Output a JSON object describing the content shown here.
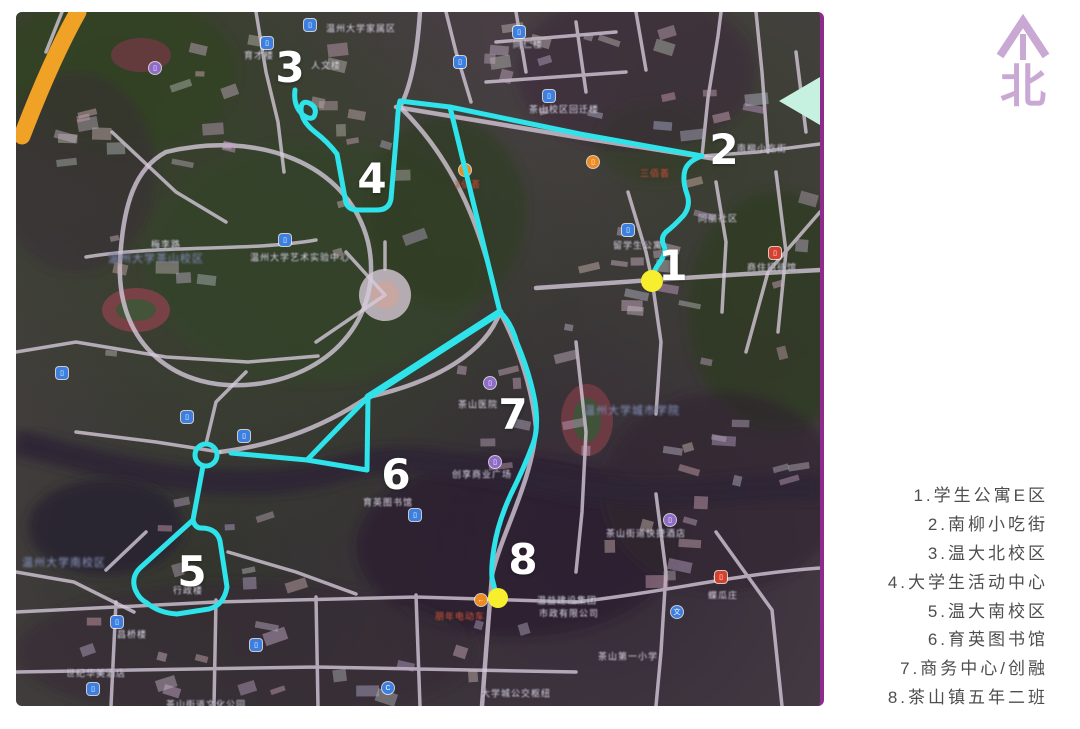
{
  "compass": {
    "north_label": "北",
    "color": "#c9a8d4"
  },
  "legend": {
    "text_color": "#4e4e4e",
    "items": [
      "1.学生公寓E区",
      "2.南柳小吃街",
      "3.温大北校区",
      "4.大学生活动中心",
      "5.温大南校区",
      "6.育英图书馆",
      "7.商务中心/创融",
      "8.茶山镇五年二班"
    ]
  },
  "map": {
    "edge_color": "#8e2b8c",
    "direction_arrow_color": "#c6f0e0",
    "route": {
      "color": "#2ee3ea",
      "stroke_width": 5,
      "paths": [
        "M 279,78 Q 277,94 287,103 Q 297,110 299,102 Q 301,95 293,91 Q 285,88 285,98 Q 286,110 299,120 Q 312,130 321,142 L 329,186 Q 330,198 342,198 L 361,198 Q 373,198 375,187 L 381,116 Q 382,95 384,89",
        "M 384,89 L 434,95 L 564,122 L 686,144",
        "M 686,144 Q 672,149 669,158 Q 666,168 671,182 Q 675,193 668,203 Q 658,214 650,220 Q 644,226 648,234 Q 651,240 644,250 Q 637,259 636,268",
        "M 434,95 L 481,288 L 484,300",
        "M 484,300 Q 495,310 501,331 Q 514,362 519,390 Q 523,416 517,432 Q 508,456 495,482 Q 482,510 478,536 Q 475,555 476,566 L 481,586",
        "M 484,300 L 352,385",
        "M 352,385 L 291,448 M 352,385 L 351,458",
        "M 351,458 L 291,448 L 215,441",
        "M 187,454 L 177,508",
        "M 177,508 L 124,556 Q 115,565 119,577 Q 123,587 131,591 Q 143,601 161,602 L 193,597 Q 208,593 211,575 L 204,529 Q 201,517 187,516 Q 179,517 177,508"
      ],
      "circles": [
        {
          "x": 190,
          "y": 443,
          "r": 11
        }
      ]
    },
    "stop_numbers": [
      {
        "label": "1",
        "x": 657,
        "y": 254
      },
      {
        "label": "2",
        "x": 708,
        "y": 138
      },
      {
        "label": "3",
        "x": 274,
        "y": 56
      },
      {
        "label": "4",
        "x": 356,
        "y": 167
      },
      {
        "label": "5",
        "x": 176,
        "y": 560
      },
      {
        "label": "6",
        "x": 380,
        "y": 463
      },
      {
        "label": "7",
        "x": 497,
        "y": 403
      },
      {
        "label": "8",
        "x": 507,
        "y": 548
      }
    ],
    "endpoint_dots": [
      {
        "x": 636,
        "y": 269,
        "r": 11
      },
      {
        "x": 482,
        "y": 586,
        "r": 10
      }
    ],
    "endpoint_dot_color": "#f7ef2d",
    "area_labels": [
      {
        "text": "温州大学家属区",
        "x": 345,
        "y": 16,
        "c": "w"
      },
      {
        "text": "人文楼",
        "x": 310,
        "y": 53,
        "c": "w"
      },
      {
        "text": "育才楼",
        "x": 243,
        "y": 43,
        "c": "w"
      },
      {
        "text": "同仁楼",
        "x": 512,
        "y": 32,
        "c": "w"
      },
      {
        "text": "茶山校区回迁楼",
        "x": 548,
        "y": 97,
        "c": "w"
      },
      {
        "text": "温州大学茶山校区",
        "x": 140,
        "y": 246,
        "c": "b"
      },
      {
        "text": "温州大学艺术实验中心",
        "x": 284,
        "y": 245,
        "c": "w"
      },
      {
        "text": "三佰荟",
        "x": 639,
        "y": 161,
        "c": "r"
      },
      {
        "text": "2佰荟",
        "x": 452,
        "y": 172,
        "c": "r"
      },
      {
        "text": "留学生公寓",
        "x": 622,
        "y": 233,
        "c": "w"
      },
      {
        "text": "南柳小吃街",
        "x": 746,
        "y": 136,
        "c": "w"
      },
      {
        "text": "同丽社区",
        "x": 702,
        "y": 206,
        "c": "w"
      },
      {
        "text": "商住招待馆",
        "x": 756,
        "y": 255,
        "c": "w"
      },
      {
        "text": "梅李路",
        "x": 150,
        "y": 232,
        "c": "w"
      },
      {
        "text": "育英图书馆",
        "x": 372,
        "y": 490,
        "c": "w"
      },
      {
        "text": "温州大学南校区",
        "x": 48,
        "y": 550,
        "c": "b"
      },
      {
        "text": "行政楼",
        "x": 172,
        "y": 578,
        "c": "w"
      },
      {
        "text": "茶山医院",
        "x": 462,
        "y": 392,
        "c": "w"
      },
      {
        "text": "创享商业广场",
        "x": 466,
        "y": 462,
        "c": "w"
      },
      {
        "text": "温州大学城市学院",
        "x": 616,
        "y": 398,
        "c": "b"
      },
      {
        "text": "茶山街道快捷酒店",
        "x": 630,
        "y": 521,
        "c": "w"
      },
      {
        "text": "蝶瓜庄",
        "x": 707,
        "y": 583,
        "c": "w"
      },
      {
        "text": "茶山第一小学",
        "x": 612,
        "y": 644,
        "c": "w"
      },
      {
        "text": "世纪华美酒店",
        "x": 80,
        "y": 661,
        "c": "w"
      },
      {
        "text": "昌桥楼",
        "x": 116,
        "y": 622,
        "c": "w"
      },
      {
        "text": "茶山街道文化公园",
        "x": 190,
        "y": 692,
        "c": "w"
      },
      {
        "text": "大学城公交枢纽",
        "x": 500,
        "y": 681,
        "c": "w"
      },
      {
        "text": "朋年电动车",
        "x": 444,
        "y": 604,
        "c": "r"
      },
      {
        "text": "温益建设集团",
        "x": 551,
        "y": 588,
        "c": "w"
      },
      {
        "text": "市政有限公司",
        "x": 553,
        "y": 601,
        "c": "w"
      }
    ],
    "poi_icons": [
      {
        "x": 294,
        "y": 13,
        "kind": "blue"
      },
      {
        "x": 503,
        "y": 20,
        "kind": "blue"
      },
      {
        "x": 533,
        "y": 84,
        "kind": "blue"
      },
      {
        "x": 251,
        "y": 31,
        "kind": "blue"
      },
      {
        "x": 269,
        "y": 228,
        "kind": "blue"
      },
      {
        "x": 612,
        "y": 218,
        "kind": "blue"
      },
      {
        "x": 46,
        "y": 361,
        "kind": "blue"
      },
      {
        "x": 171,
        "y": 405,
        "kind": "blue"
      },
      {
        "x": 228,
        "y": 424,
        "kind": "blue"
      },
      {
        "x": 399,
        "y": 503,
        "kind": "blue"
      },
      {
        "x": 101,
        "y": 610,
        "kind": "blue"
      },
      {
        "x": 240,
        "y": 633,
        "kind": "blue"
      },
      {
        "x": 77,
        "y": 677,
        "kind": "blue"
      },
      {
        "x": 444,
        "y": 50,
        "kind": "blue"
      },
      {
        "x": 661,
        "y": 600,
        "kind": "blue-circle",
        "glyph": "文"
      },
      {
        "x": 372,
        "y": 676,
        "kind": "blue-circle",
        "glyph": "C"
      },
      {
        "x": 577,
        "y": 150,
        "kind": "orange"
      },
      {
        "x": 449,
        "y": 158,
        "kind": "orange"
      },
      {
        "x": 465,
        "y": 588,
        "kind": "orange",
        "glyph": "←"
      },
      {
        "x": 474,
        "y": 371,
        "kind": "purple"
      },
      {
        "x": 479,
        "y": 450,
        "kind": "purple"
      },
      {
        "x": 654,
        "y": 508,
        "kind": "purple"
      },
      {
        "x": 139,
        "y": 56,
        "kind": "purple"
      },
      {
        "x": 759,
        "y": 241,
        "kind": "red"
      },
      {
        "x": 705,
        "y": 565,
        "kind": "red"
      }
    ],
    "poi_colors": {
      "blue": "#3d7fe0",
      "blue-circle": "#3d7fe0",
      "orange": "#ef8a1f",
      "purple": "#8f6bc8",
      "red": "#d8402e"
    }
  }
}
